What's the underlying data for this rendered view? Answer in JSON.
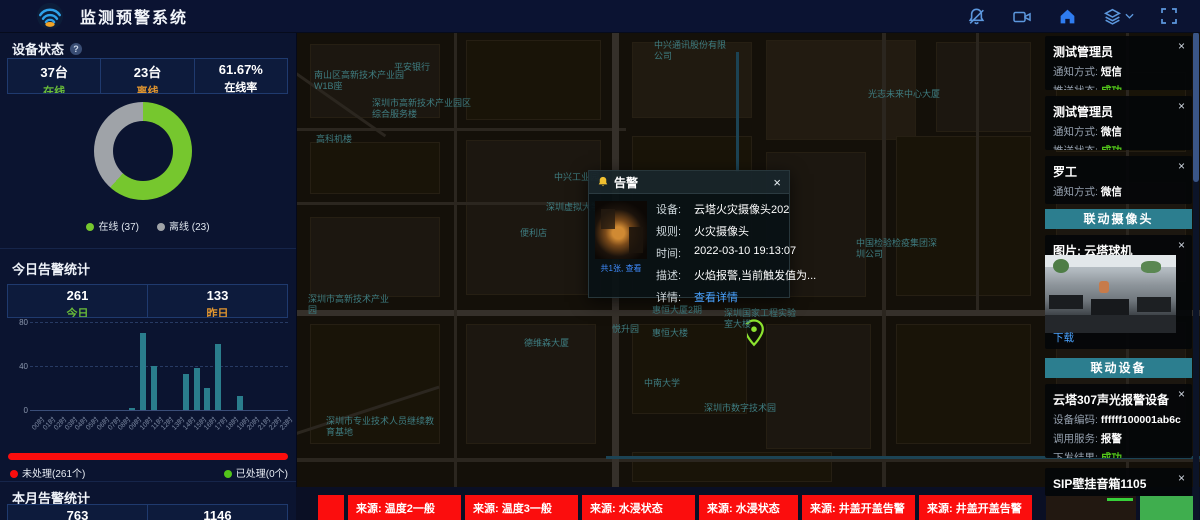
{
  "header": {
    "title": "监测预警系统"
  },
  "left_panel": {
    "device_status": {
      "title": "设备状态",
      "stats": [
        {
          "value": "37台",
          "label": "在线",
          "color": "#6abe39"
        },
        {
          "value": "23台",
          "label": "离线",
          "color": "#e0952f"
        },
        {
          "value": "61.67%",
          "label": "在线率",
          "color": "#ffffff"
        }
      ]
    },
    "today": {
      "title": "今日告警统计",
      "stats": [
        {
          "value": "261",
          "label": "今日",
          "color": "#6abe39"
        },
        {
          "value": "133",
          "label": "昨日",
          "color": "#e0952f"
        }
      ],
      "progress_legend": [
        {
          "text": "未处理(261个)",
          "color": "#fb0d0d"
        },
        {
          "text": "已处理(0个)",
          "color": "#52c41a"
        }
      ]
    },
    "month": {
      "title": "本月告警统计",
      "stats": [
        {
          "value": "763",
          "label": "",
          "color": "#ffffff"
        },
        {
          "value": "1146",
          "label": "",
          "color": "#ffffff"
        }
      ]
    }
  },
  "chart_data": [
    {
      "type": "pie",
      "donut": true,
      "title": "设备状态",
      "labels": [
        "在线",
        "离线"
      ],
      "values": [
        37,
        23
      ],
      "colors": [
        "#76c72e",
        "#9fa3a8"
      ],
      "legend": [
        "在线 (37)",
        "离线 (23)"
      ],
      "legend_position": "bottom"
    },
    {
      "type": "bar",
      "title": "今日告警统计(按小时)",
      "categories": [
        "00时",
        "01时",
        "02时",
        "03时",
        "04时",
        "05时",
        "06时",
        "07时",
        "08时",
        "09时",
        "10时",
        "11时",
        "12时",
        "13时",
        "14时",
        "15时",
        "16时",
        "17时",
        "18时",
        "19时",
        "20时",
        "21时",
        "22时",
        "23时"
      ],
      "values": [
        0,
        0,
        0,
        0,
        0,
        0,
        0,
        0,
        0,
        2,
        70,
        40,
        0,
        0,
        33,
        38,
        20,
        60,
        0,
        13,
        0,
        0,
        0,
        0
      ],
      "xlabel": "",
      "ylabel": "",
      "ylim": [
        0,
        80
      ],
      "yticks": [
        0,
        40,
        80
      ],
      "bar_color": "#2a7d8c",
      "grid": true,
      "legend_position": "none"
    }
  ],
  "map": {
    "labels": [
      {
        "text": "中兴通讯股份有限公司",
        "x": 358,
        "y": 8,
        "w": 78
      },
      {
        "text": "平安银行",
        "x": 98,
        "y": 30,
        "w": 60
      },
      {
        "text": "南山区高新技术产业园W1B座",
        "x": 18,
        "y": 38,
        "w": 95
      },
      {
        "text": "深圳市高新技术产业园区综合服务楼",
        "x": 76,
        "y": 66,
        "w": 105
      },
      {
        "text": "高科机楼",
        "x": 20,
        "y": 102,
        "w": 60
      },
      {
        "text": "光志未来中心大厦",
        "x": 572,
        "y": 57,
        "w": 110
      },
      {
        "text": "中兴工业园",
        "x": 258,
        "y": 140,
        "w": 70
      },
      {
        "text": "深圳虚拟大学园",
        "x": 250,
        "y": 170,
        "w": 95
      },
      {
        "text": "便利店",
        "x": 224,
        "y": 196,
        "w": 48
      },
      {
        "text": "中国检验检疫集团深圳公司",
        "x": 560,
        "y": 206,
        "w": 88
      },
      {
        "text": "深圳市高新技术产业园",
        "x": 12,
        "y": 262,
        "w": 85
      },
      {
        "text": "德维森大厦",
        "x": 228,
        "y": 306,
        "w": 70
      },
      {
        "text": "惠恒大厦2期",
        "x": 356,
        "y": 273,
        "w": 75
      },
      {
        "text": "悦升园",
        "x": 316,
        "y": 292,
        "w": 40
      },
      {
        "text": "惠恒大楼",
        "x": 356,
        "y": 296,
        "w": 55
      },
      {
        "text": "深圳国家工程实验室大楼",
        "x": 428,
        "y": 276,
        "w": 80
      },
      {
        "text": "中南大学",
        "x": 348,
        "y": 346,
        "w": 55
      },
      {
        "text": "深圳市数字技术园",
        "x": 408,
        "y": 371,
        "w": 105
      },
      {
        "text": "深圳市专业技术人员继续教育基地",
        "x": 30,
        "y": 384,
        "w": 112
      }
    ]
  },
  "popup": {
    "title": "告警",
    "close": "×",
    "thumb_caption": "共1张, 查看",
    "fields": [
      {
        "label": "设备:",
        "value": "云塔火灾摄像头202"
      },
      {
        "label": "规则:",
        "value": "火灾摄像头"
      },
      {
        "label": "时间:",
        "value": "2022-03-10 19:13:07"
      },
      {
        "label": "描述:",
        "value": "火焰报警,当前触发值为..."
      },
      {
        "label": "详情:",
        "value": "查看详情",
        "link": true
      }
    ]
  },
  "right_panel": {
    "close": "×",
    "notifications": [
      {
        "name": "测试管理员",
        "rows": [
          {
            "label": "通知方式:",
            "value": "短信",
            "color": "#ffffff"
          },
          {
            "label": "推送状态:",
            "value": "成功",
            "color": "#52c41a"
          }
        ]
      },
      {
        "name": "测试管理员",
        "rows": [
          {
            "label": "通知方式:",
            "value": "微信",
            "color": "#ffffff"
          },
          {
            "label": "推送状态:",
            "value": "成功",
            "color": "#52c41a"
          }
        ]
      },
      {
        "name": "罗工",
        "rows": [
          {
            "label": "通知方式:",
            "value": "微信",
            "color": "#ffffff"
          },
          {
            "label": "推送状态:",
            "value": "成功",
            "color": "#52c41a"
          }
        ]
      }
    ],
    "camera_section": {
      "header": "联动摄像头",
      "card_title": "图片: 云塔球机",
      "download": "下载"
    },
    "device_section": {
      "header": "联动设备",
      "cards": [
        {
          "title": "云塔307声光报警设备",
          "rows": [
            {
              "label": "设备编码:",
              "value": "ffffff100001ab6c",
              "color": "#ffffff"
            },
            {
              "label": "调用服务:",
              "value": "报警",
              "color": "#ffffff"
            },
            {
              "label": "下发结果:",
              "value": "成功",
              "color": "#52c41a"
            }
          ]
        },
        {
          "title": "SIP壁挂音箱1105",
          "rows": [
            {
              "label": "设备编码:",
              "value": "1105",
              "color": "#ffffff"
            }
          ]
        }
      ]
    }
  },
  "bottom_bar": {
    "alerts": [
      {
        "text": "",
        "w": 26
      },
      {
        "text": "来源: 温度2一般",
        "w": 113
      },
      {
        "text": "来源: 温度3一般",
        "w": 113
      },
      {
        "text": "来源: 水浸状态",
        "w": 113
      },
      {
        "text": "来源: 水浸状态",
        "w": 99
      },
      {
        "text": "来源: 井盖开盖告警",
        "w": 113
      },
      {
        "text": "来源: 井盖开盖告警",
        "w": 113
      }
    ]
  }
}
